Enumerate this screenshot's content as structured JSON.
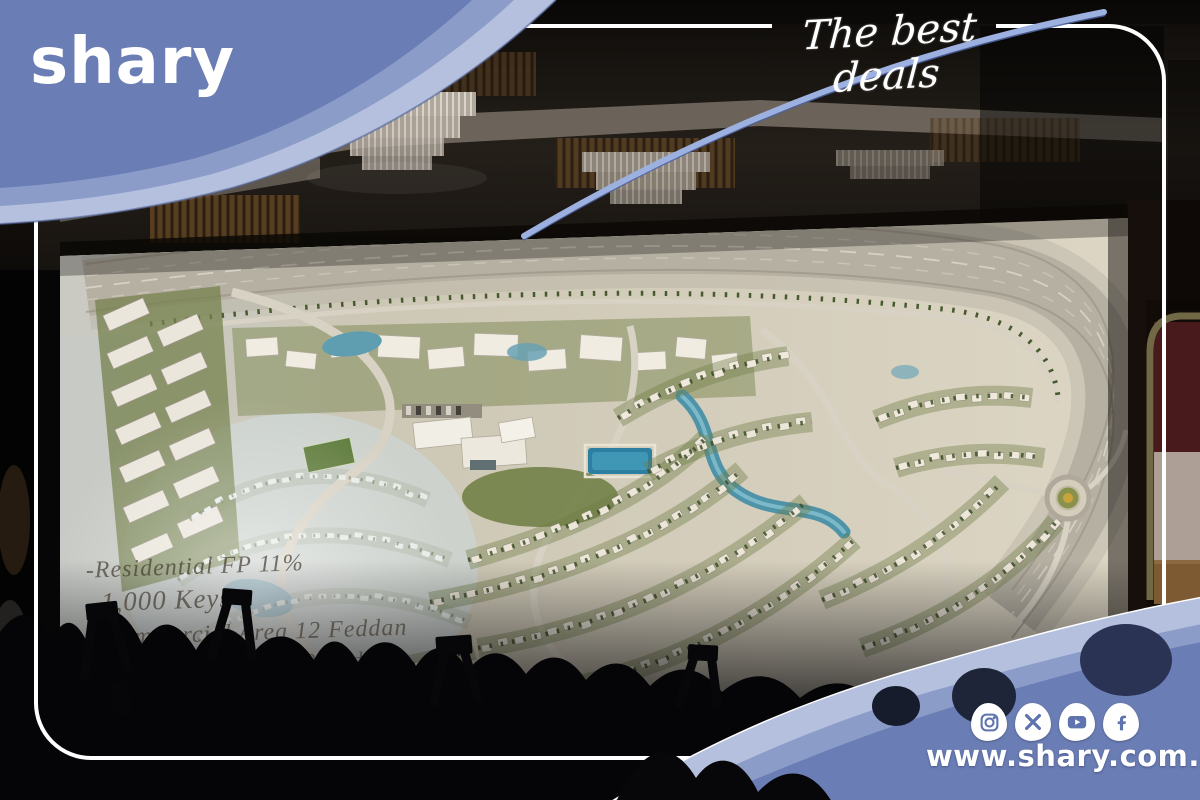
{
  "brand": {
    "logo_text": "shary",
    "tagline": "The best deals",
    "website": "www.shary.com.eg"
  },
  "scene": {
    "screen_overlay_lines": [
      "-Residential FP 11%",
      "-1,000 Keys",
      "-Commercial Area 12 Feddan",
      "-Sports Club Area 10 Feddan",
      "-Landscape Area Feddan"
    ]
  },
  "social": {
    "icons": [
      {
        "name": "instagram"
      },
      {
        "name": "x"
      },
      {
        "name": "youtube"
      },
      {
        "name": "facebook"
      }
    ]
  },
  "colors": {
    "accent_blue": "#6a7db4",
    "band_mid": "#8b9cc9",
    "band_light": "#b5c0de",
    "icon_glyph_blue": "#5f74ae",
    "text_white": "#ffffff"
  }
}
